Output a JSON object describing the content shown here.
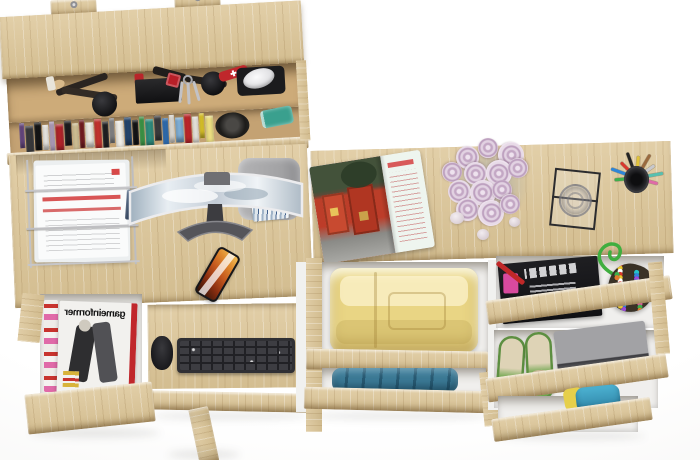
{
  "scene": {
    "description": "Top-down 3D render of a light sonoma-oak home office set: wall shelf with cosmetics and books, desk with curved monitor, document tray, phone and keyboard tray, side desk with rose bouquet, open magazine, glass and pen cup, plus open drawers holding folded clothes, magazines, shoes and accessories",
    "background": "#ffffff",
    "wood_color": "#d9c59c"
  },
  "shelf": {
    "book_colors": [
      "#6b4a86",
      "#39393b",
      "#161616",
      "#f2efe9",
      "#b9a6c6",
      "#b3242a",
      "#1c1c1e",
      "#d9c89a",
      "#7a1d22",
      "#efece4",
      "#c8332e",
      "#202022",
      "#8a8a8c",
      "#f4f1ea",
      "#24456e",
      "#141416",
      "#3f9e49",
      "#2f8f80",
      "#3c3c3e",
      "#2f6fb5",
      "#eeeae2",
      "#7fb0d8",
      "#c2262b",
      "#f1ede5",
      "#e8cf2a",
      "#f0e283"
    ],
    "basket_color": "#9a7748",
    "glass_color": "#3aa08e",
    "hat_color": "#2b2a28"
  },
  "desk_left": {
    "magazine_title": "gameinformer",
    "magazine_spine_color": "#c0272c",
    "keyboard_color": "#303034",
    "mouse_color": "#232326",
    "phone_screen_color": "#c4581e",
    "paper_accent": "#d84848",
    "chair_color": "#a7a7a9"
  },
  "desk_right": {
    "rose_color": "#cdb2cc",
    "rose_count": 13,
    "pebble_count": 3,
    "pen_colors": [
      "#3fae4c",
      "#2e86d8",
      "#d8392e",
      "#232323",
      "#e0c23a",
      "#9a6a3f",
      "#c8c8cc",
      "#57c0b0",
      "#e06aa8"
    ],
    "bead_colors": [
      "#d8392e",
      "#2e86d8",
      "#3fae4c",
      "#e8c62e",
      "#9a4ad8",
      "#e07a2e",
      "#ffffff",
      "#26c2c8",
      "#e055a0"
    ],
    "clothes_yellow": "#e9d584",
    "clothes_blue": "#3c7a96",
    "shoes_color": "#6fa64e",
    "box_color": "#98989b",
    "strap_color": "#3fae3f"
  }
}
